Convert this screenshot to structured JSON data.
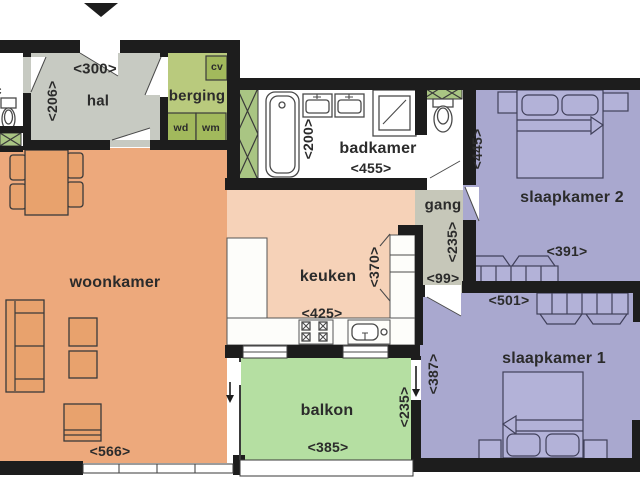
{
  "title": "apartment-floor-plan",
  "colors": {
    "wall": "#1d1d1d",
    "woonkamer": "#eda97c",
    "keuken": "#f6d2b8",
    "balkon": "#b5dfa2",
    "bedroom": "#a9a8cf",
    "bedFurniture": "#b3b2d8",
    "bedOutline": "#40405a",
    "hal": "#c7cac2",
    "gang": "#c6c7b9",
    "berging": "#b9ca7d",
    "bergingUnit": "#a2b95c",
    "shaft": "#a9c583",
    "furniture": "#e8a26d",
    "outline": "#3a3a3a",
    "text": "#2b2b2b"
  },
  "rooms": {
    "wc": {
      "name": "wc"
    },
    "hal": {
      "name": "hal",
      "width": "<300>",
      "depth": "<206>"
    },
    "berging": {
      "name": "berging",
      "units": {
        "cv": "cv",
        "wd": "wd",
        "wm": "wm"
      }
    },
    "badkamer": {
      "name": "badkamer",
      "width": "<455>",
      "depth": "<200>"
    },
    "gang": {
      "name": "gang",
      "depth": "<235>",
      "width": "<99>"
    },
    "slaapkamer2": {
      "name": "slaapkamer 2",
      "depth": "<445>",
      "width": "<391>"
    },
    "slaapkamer1": {
      "name": "slaapkamer 1",
      "width": "<501>",
      "depth": "<387>"
    },
    "keuken": {
      "name": "keuken",
      "width": "<425>",
      "depth": "<370>"
    },
    "woonkamer": {
      "name": "woonkamer",
      "width": "<566>"
    },
    "balkon": {
      "name": "balkon",
      "width": "<385>",
      "depth": "<235>"
    }
  }
}
